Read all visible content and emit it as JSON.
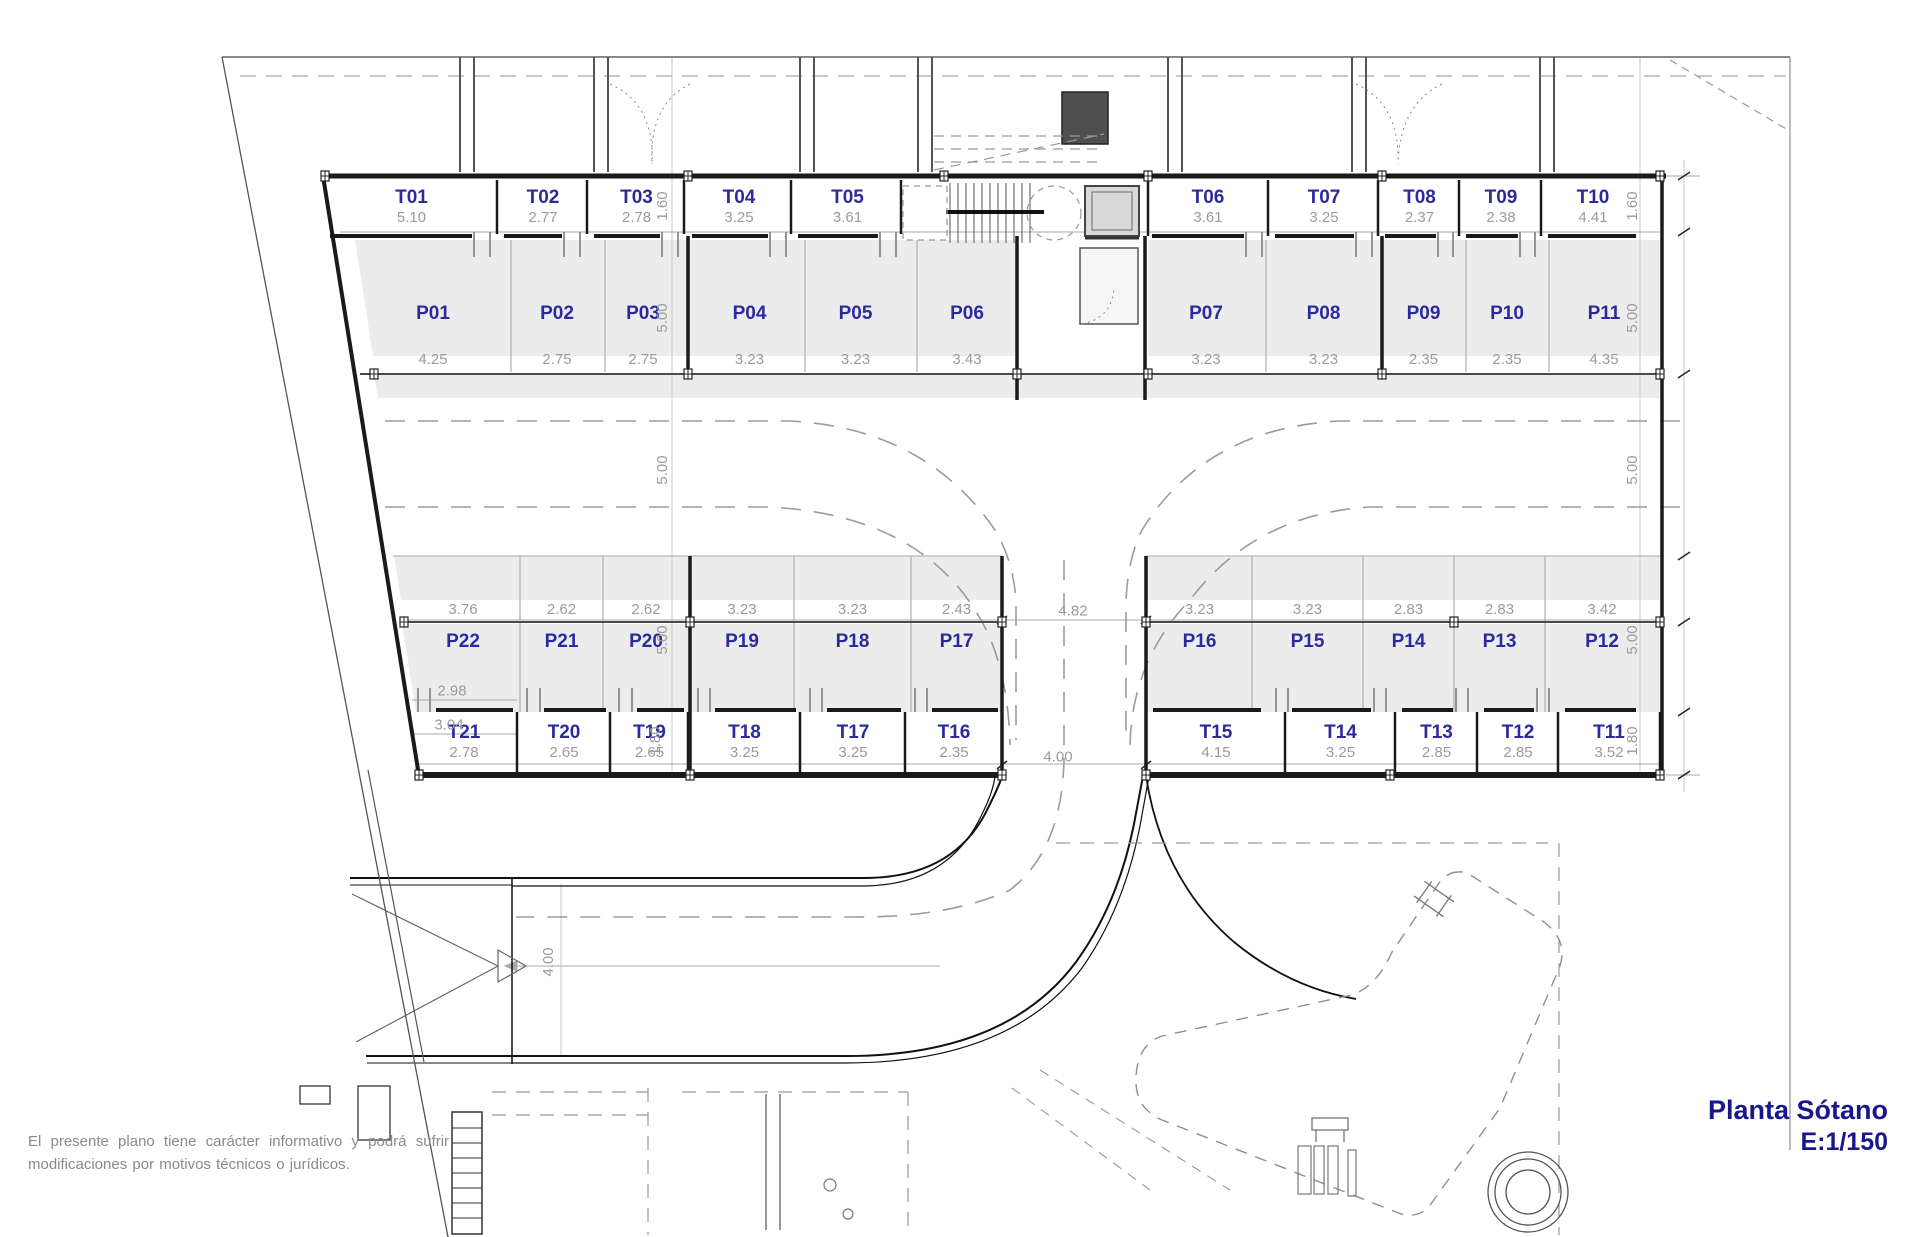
{
  "title": {
    "line1": "Planta Sótano",
    "line2": "E:1/150"
  },
  "disclaimer": {
    "line1": "El presente plano tiene carácter informativo y podrá sufrir",
    "line2": "modificaciones por motivos técnicos o jurídicos."
  },
  "colors": {
    "label_blue": "#2b2b9e",
    "title_navy": "#18188c",
    "dim_gray": "#9b9b9b",
    "stall_fill": "#ececec",
    "wall_black": "#1a1a1a"
  },
  "storage_top": [
    {
      "label": "T01",
      "dim": "5.10"
    },
    {
      "label": "T02",
      "dim": "2.77"
    },
    {
      "label": "T03",
      "dim": "2.78"
    },
    {
      "label": "T04",
      "dim": "3.25"
    },
    {
      "label": "T05",
      "dim": "3.61"
    },
    {
      "label": "T06",
      "dim": "3.61"
    },
    {
      "label": "T07",
      "dim": "3.25"
    },
    {
      "label": "T08",
      "dim": "2.37"
    },
    {
      "label": "T09",
      "dim": "2.38"
    },
    {
      "label": "T10",
      "dim": "4.41"
    }
  ],
  "parking_top": [
    {
      "label": "P01",
      "dim": "4.25"
    },
    {
      "label": "P02",
      "dim": "2.75"
    },
    {
      "label": "P03",
      "dim": "2.75"
    },
    {
      "label": "P04",
      "dim": "3.23"
    },
    {
      "label": "P05",
      "dim": "3.23"
    },
    {
      "label": "P06",
      "dim": "3.43"
    },
    {
      "label": "P07",
      "dim": "3.23"
    },
    {
      "label": "P08",
      "dim": "3.23"
    },
    {
      "label": "P09",
      "dim": "2.35"
    },
    {
      "label": "P10",
      "dim": "2.35"
    },
    {
      "label": "P11",
      "dim": "4.35"
    }
  ],
  "parking_bottom": [
    {
      "label": "P22",
      "dim": "3.76"
    },
    {
      "label": "P21",
      "dim": "2.62"
    },
    {
      "label": "P20",
      "dim": "2.62"
    },
    {
      "label": "P19",
      "dim": "3.23"
    },
    {
      "label": "P18",
      "dim": "3.23"
    },
    {
      "label": "P17",
      "dim": "2.43"
    },
    {
      "label": "P16",
      "dim": "3.23"
    },
    {
      "label": "P15",
      "dim": "3.23"
    },
    {
      "label": "P14",
      "dim": "2.83"
    },
    {
      "label": "P13",
      "dim": "2.83"
    },
    {
      "label": "P12",
      "dim": "3.42"
    }
  ],
  "storage_bottom": [
    {
      "label": "T21",
      "dim": "2.78"
    },
    {
      "label": "T20",
      "dim": "2.65"
    },
    {
      "label": "T19",
      "dim": "2.65"
    },
    {
      "label": "T18",
      "dim": "3.25"
    },
    {
      "label": "T17",
      "dim": "3.25"
    },
    {
      "label": "T16",
      "dim": "2.35"
    },
    {
      "label": "T15",
      "dim": "4.15"
    },
    {
      "label": "T14",
      "dim": "3.25"
    },
    {
      "label": "T13",
      "dim": "2.85"
    },
    {
      "label": "T12",
      "dim": "2.85"
    },
    {
      "label": "T11",
      "dim": "3.52"
    }
  ],
  "vertical_dims": {
    "storage_top_height": "1.60",
    "parking_depth": "5.00",
    "aisle_width": "5.00",
    "storage_bottom_height": "1.80",
    "ramp_width": "4.00"
  },
  "misc_dims": {
    "bottom_gap_width": "4.82",
    "exit_width": "4.00",
    "p22_inner": "2.98",
    "p22_outer": "3.04"
  }
}
